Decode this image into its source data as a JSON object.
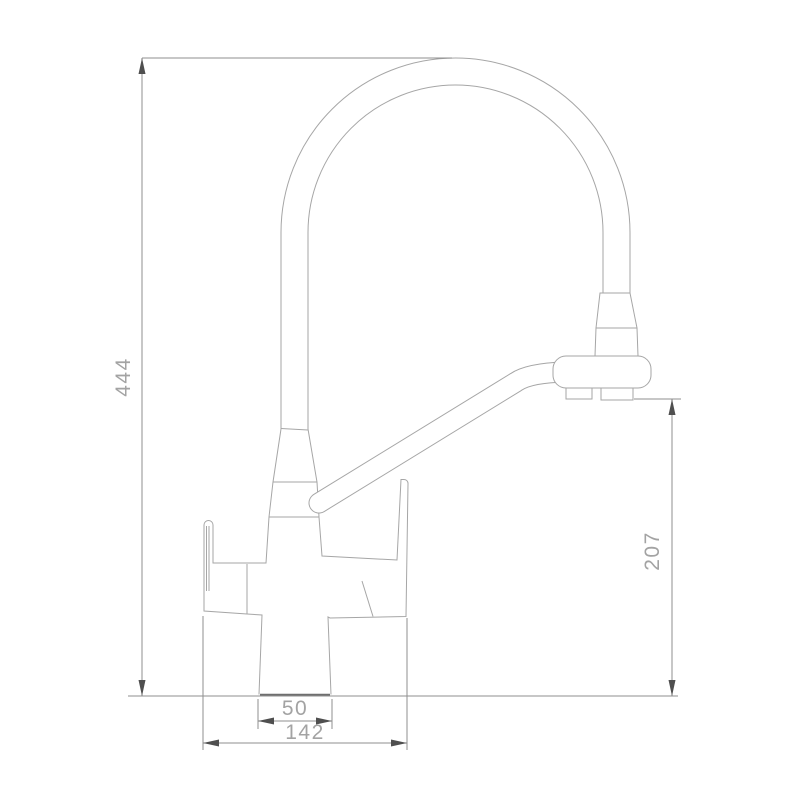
{
  "title": "Faucet technical dimension drawing",
  "drawing": {
    "type": "technical-dimension-drawing",
    "subject": "two-handle kitchen faucet with gooseneck spout, side elevation",
    "units_implied": "mm",
    "dimensions": {
      "overall_height": "444",
      "spout_height": "207",
      "body_base_width": "50",
      "overall_width": "142"
    },
    "colors": {
      "background": "#ffffff",
      "outline": "#a6a6a6",
      "dimension_line": "#8f8f8f",
      "arrow": "#4f4f4f",
      "label_text": "#a3a3a3",
      "base_line": "#6e6e6e"
    }
  }
}
